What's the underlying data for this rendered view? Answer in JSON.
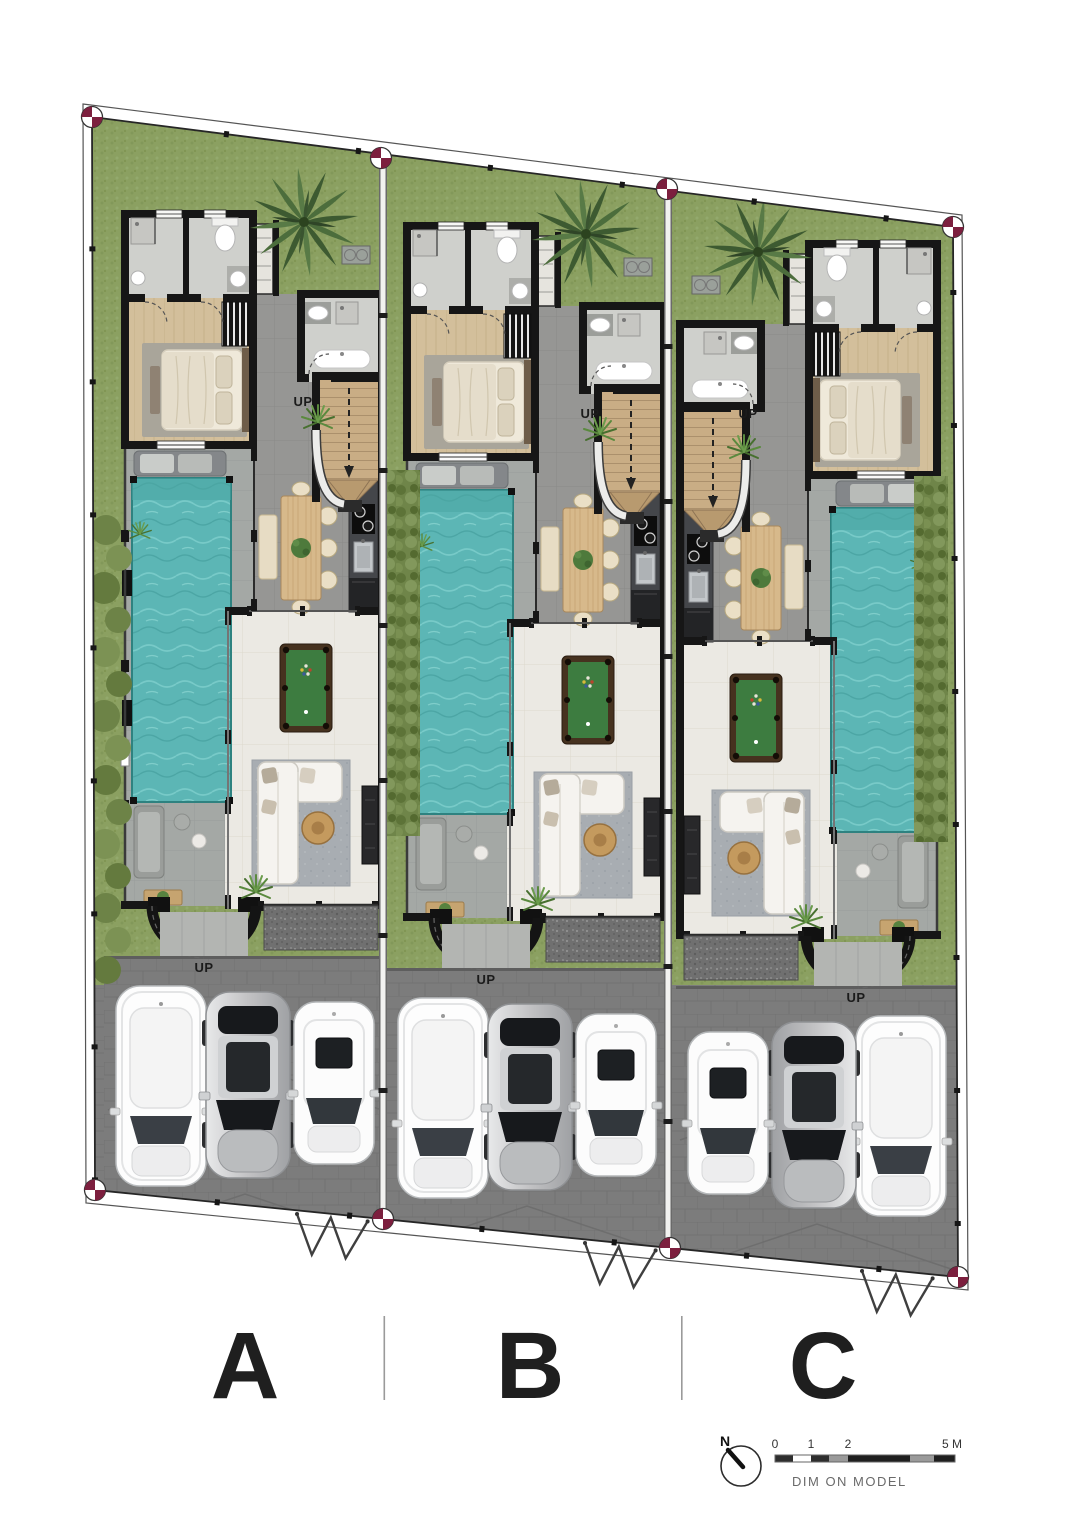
{
  "plan": {
    "units": [
      {
        "label": "A"
      },
      {
        "label": "B"
      },
      {
        "label": "C"
      }
    ],
    "stairs_up_label": "UP",
    "entrance_up_label": "UP"
  },
  "footer": {
    "compass_north": "N",
    "scale_ticks": [
      "0",
      "1",
      "2",
      "5 M"
    ],
    "scale_caption": "DIM ON MODEL"
  },
  "palette": {
    "grass": "#8ba061",
    "hedge": "#6f8549",
    "pool_water": "#5cb6b5",
    "walls": "#161616",
    "hall_floor": "#969694",
    "living_floor": "#ebe9e3",
    "bedroom_wood": "#d3bf9b",
    "deck": "#a4a8a5",
    "driveway": "#7c7c7c",
    "pool_table_felt": "#3d7c40",
    "dining_wood": "#d7b98b",
    "survey_marker": "#7c1f3e",
    "car_silver": "#c2c2c4",
    "car_white": "#fdfdfd"
  }
}
